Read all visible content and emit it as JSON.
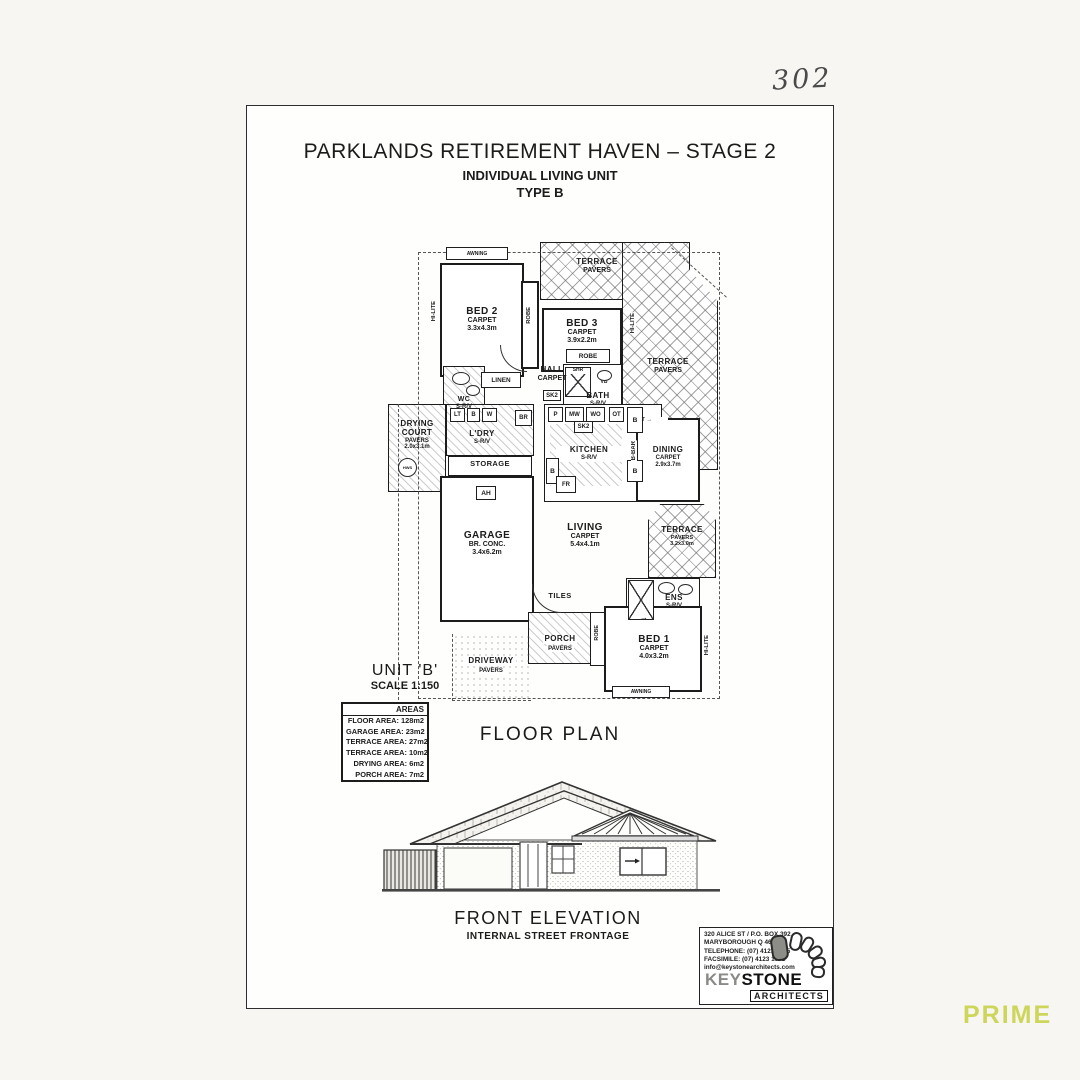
{
  "annotations": {
    "sheet_number": "302",
    "watermark": "PRIME",
    "watermark_color": "#cdd65a"
  },
  "title": {
    "line1": "PARKLANDS RETIREMENT HAVEN – STAGE 2",
    "line2": "INDIVIDUAL LIVING UNIT",
    "line3": "TYPE B"
  },
  "plan": {
    "rooms": [
      {
        "name": "BED 2",
        "sub": "CARPET",
        "dims": "3.3x4.3m"
      },
      {
        "name": "BED 3",
        "sub": "CARPET",
        "dims": "3.9x2.2m"
      },
      {
        "name": "TERRACE",
        "sub": "PAVERS"
      },
      {
        "name": "TERRACE",
        "sub": "PAVERS"
      },
      {
        "name": "HALL",
        "sub": "CARPET"
      },
      {
        "name": "WC",
        "sub": "S-R/V"
      },
      {
        "name": "DRYING COURT",
        "sub": "PAVERS",
        "dims": "2.0x3.1m"
      },
      {
        "name": "L'DRY",
        "sub": "S-R/V"
      },
      {
        "name": "STORAGE"
      },
      {
        "name": "GARAGE",
        "sub": "BR. CONC.",
        "dims": "3.4x6.2m"
      },
      {
        "name": "BATH",
        "sub": "S-R/V"
      },
      {
        "name": "KITCHEN",
        "sub": "S-R/V"
      },
      {
        "name": "DINING",
        "sub": "CARPET",
        "dims": "2.9x3.7m"
      },
      {
        "name": "LIVING",
        "sub": "CARPET",
        "dims": "5.4x4.1m"
      },
      {
        "name": "TERRACE",
        "sub": "PAVERS",
        "dims": "3.2x3.0m"
      },
      {
        "name": "ENS",
        "sub": "S-R/V"
      },
      {
        "name": "PORCH",
        "sub": "PAVERS"
      },
      {
        "name": "DRIVEWAY",
        "sub": "PAVERS"
      },
      {
        "name": "BED 1",
        "sub": "CARPET",
        "dims": "4.0x3.2m"
      }
    ],
    "fix": {
      "awning": "AWNING",
      "robe": "ROBE",
      "linen": "LINEN",
      "sk2": "SK2",
      "shr": "SHR",
      "vb": "VB",
      "lt": "LT",
      "b": "B",
      "w": "W",
      "br": "BR",
      "p": "P",
      "mw": "MW",
      "wo": "WO",
      "ot": "OT",
      "fr": "FR",
      "bbar": "B-BAR",
      "tt": "TT →",
      "ah": "AH",
      "hws": "HWS",
      "tiles": "TILES",
      "hilite": "HI-LITE",
      "arrow": "→"
    }
  },
  "unit": {
    "name": "UNIT 'B'",
    "scale": "SCALE 1:150"
  },
  "areas": {
    "header": "AREAS",
    "rows": [
      {
        "label": "FLOOR AREA:",
        "value": "128m2"
      },
      {
        "label": "GARAGE AREA:",
        "value": "23m2"
      },
      {
        "label": "TERRACE AREA:",
        "value": "27m2"
      },
      {
        "label": "TERRACE AREA:",
        "value": "10m2"
      },
      {
        "label": "DRYING AREA:",
        "value": "6m2"
      },
      {
        "label": "PORCH AREA:",
        "value": "7m2"
      }
    ]
  },
  "captions": {
    "floor_plan": "FLOOR PLAN",
    "front_elevation": "FRONT ELEVATION",
    "front_elevation_sub": "INTERNAL STREET FRONTAGE"
  },
  "architect": {
    "address1": "320 ALICE ST / P.O. BOX 392",
    "address2": "MARYBOROUGH Q 4650",
    "phone": "TELEPHONE: (07) 4123 1005",
    "fax": "FACSIMILE: (07) 4123 1001",
    "email": "info@keystonearchitects.com",
    "brand_key": "KEY",
    "brand_stone": "STONE",
    "brand_sub": "ARCHITECTS"
  }
}
